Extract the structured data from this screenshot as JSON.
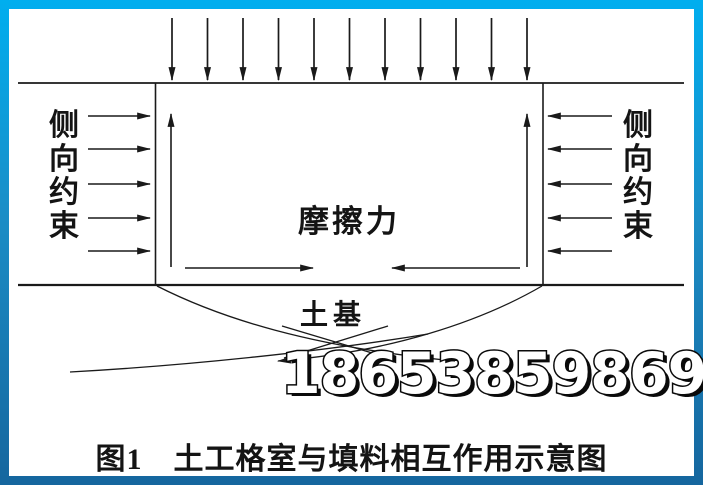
{
  "page": {
    "background": "#ffffff",
    "frame_top_color": "#00aeef",
    "frame_bottom_color": "#15669e",
    "line_color": "#1a1a1a"
  },
  "diagram": {
    "left_constraint_label": "侧向约束",
    "right_constraint_label": "侧向约束",
    "friction_label": "摩擦力",
    "subgrade_label": "土基",
    "watermark_number": "18653859869",
    "caption": "图1　土工格室与填料相互作用示意图"
  }
}
